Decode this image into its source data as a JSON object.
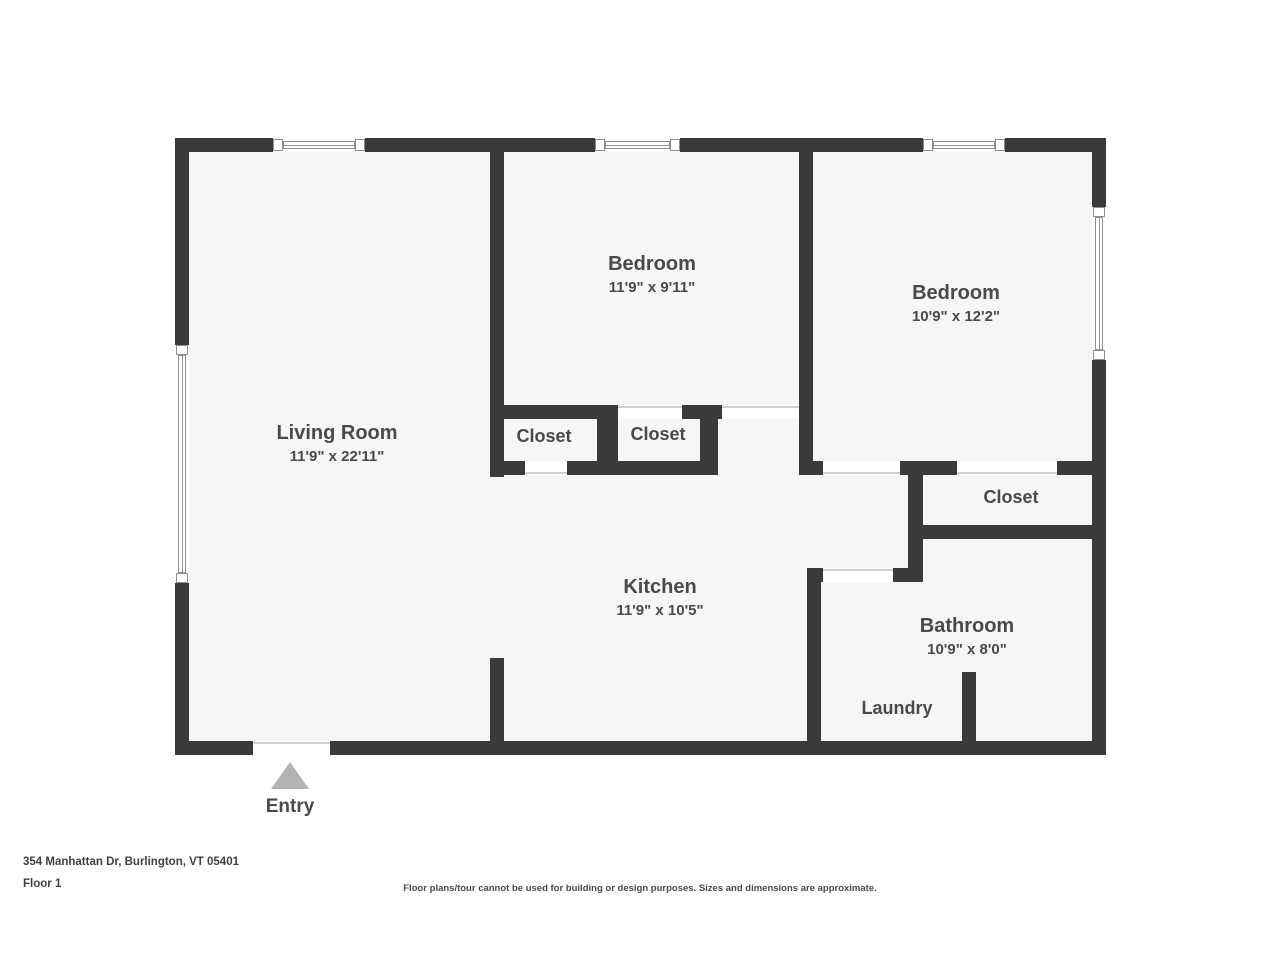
{
  "plan": {
    "rooms": [
      {
        "id": "living-room",
        "name": "Living Room",
        "dims": "11'9\" x 22'11\""
      },
      {
        "id": "bedroom-1",
        "name": "Bedroom",
        "dims": "11'9\" x 9'11\""
      },
      {
        "id": "bedroom-2",
        "name": "Bedroom",
        "dims": "10'9\" x 12'2\""
      },
      {
        "id": "closet-left",
        "name": "Closet",
        "dims": ""
      },
      {
        "id": "closet-middle",
        "name": "Closet",
        "dims": ""
      },
      {
        "id": "closet-right",
        "name": "Closet",
        "dims": ""
      },
      {
        "id": "kitchen",
        "name": "Kitchen",
        "dims": "11'9\" x 10'5\""
      },
      {
        "id": "bathroom",
        "name": "Bathroom",
        "dims": "10'9\" x 8'0\""
      },
      {
        "id": "laundry",
        "name": "Laundry",
        "dims": ""
      }
    ],
    "entry_label": "Entry"
  },
  "footer": {
    "address": "354 Manhattan Dr, Burlington, VT 05401",
    "floor": "Floor 1",
    "disclaimer": "Floor plans/tour cannot be used for building or design purposes. Sizes and dimensions are approximate."
  },
  "colors": {
    "wall": "#3a3a3a",
    "floor_fill": "#f6f6f6",
    "label_text": "#494949",
    "entry_arrow": "#b3b3b3"
  }
}
